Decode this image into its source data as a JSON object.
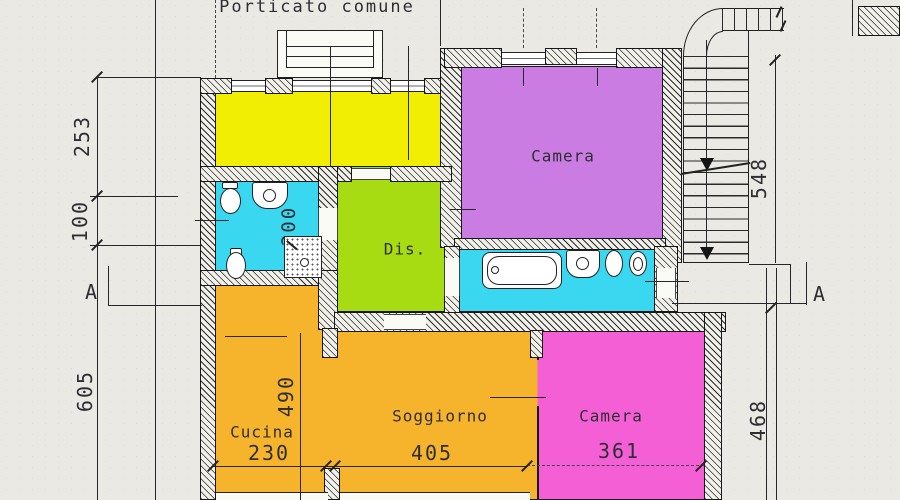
{
  "title": "Porticato comune",
  "section_labels": {
    "left": "A",
    "right": "A"
  },
  "rooms": [
    {
      "key": "locale-nord",
      "label": "",
      "color": "#f1ee04"
    },
    {
      "key": "camera-nord",
      "label": "Camera",
      "color": "#cb7ce3"
    },
    {
      "key": "bagno-ovest",
      "label": "",
      "color": "#3ad8f0"
    },
    {
      "key": "disimpegno",
      "label": "Dis.",
      "color": "#a8dc12"
    },
    {
      "key": "bagno-est",
      "label": "",
      "color": "#3ad8f0"
    },
    {
      "key": "cucina",
      "label": "Cucina",
      "color": "#f6b42c"
    },
    {
      "key": "soggiorno",
      "label": "Soggiorno",
      "color": "#f6b42c"
    },
    {
      "key": "camera-sud",
      "label": "Camera",
      "color": "#f55fd6"
    }
  ],
  "dimensions": {
    "left_top": "253",
    "left_mid": "100",
    "left_bottom": "605",
    "stairs": "548",
    "right_bottom": "468",
    "cucina_width": "230",
    "soggiorno_width": "405",
    "camera_width": "361",
    "soggiorno_depth": "490",
    "bagno_width": "200"
  },
  "colors": {
    "paper": "#eae9e4",
    "ink": "#27272b",
    "wall_fill": "#f2f1e9"
  }
}
